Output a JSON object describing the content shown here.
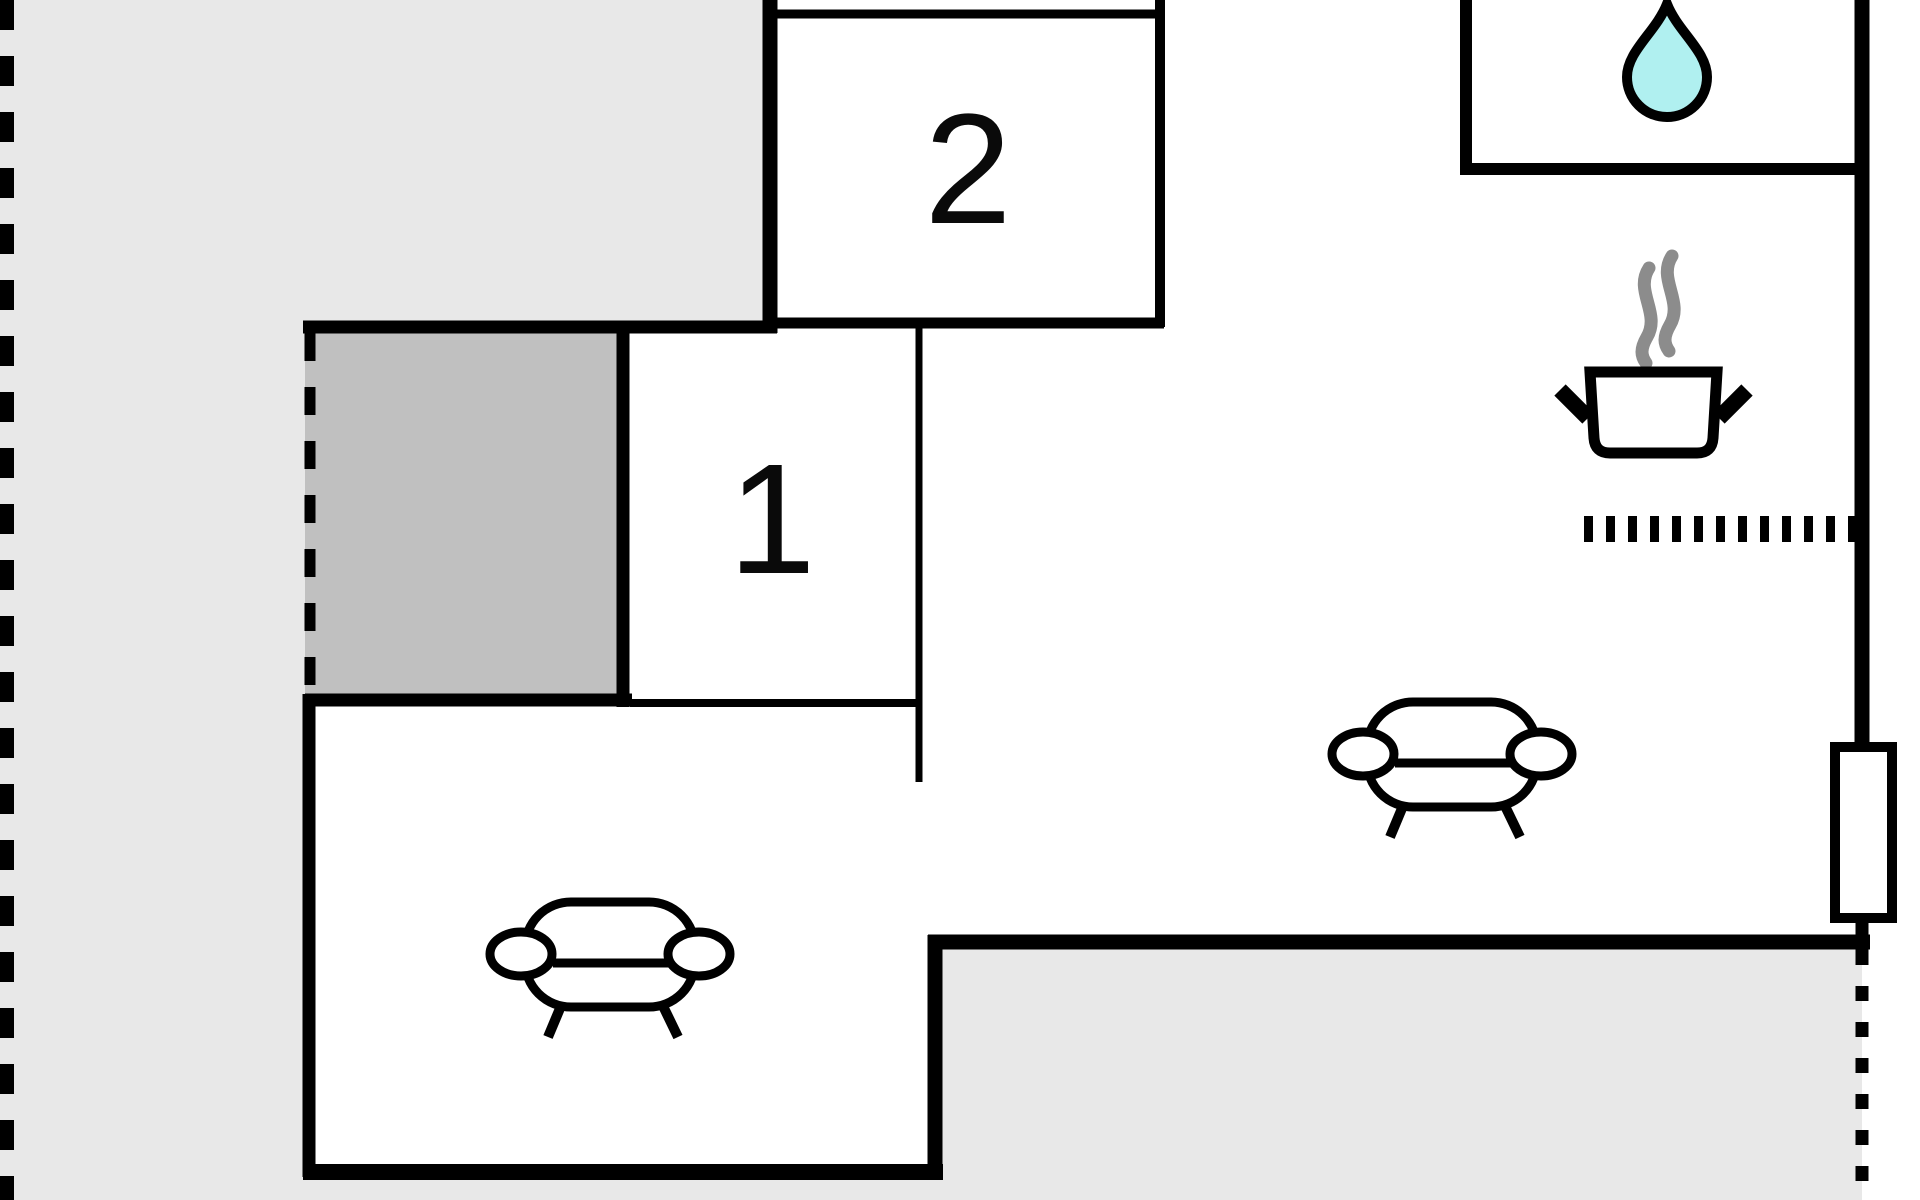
{
  "document": {
    "title": "Holiday home floor plan",
    "type": "floor-plan"
  },
  "rooms": {
    "room1": {
      "label": "1",
      "kind": "bedroom"
    },
    "room2": {
      "label": "2",
      "kind": "bedroom"
    },
    "bathroom": {
      "icon": "water-drop"
    },
    "kitchen": {
      "icons": [
        "steam",
        "cooking-pot",
        "stove-dotted-line"
      ]
    },
    "living_room": {
      "icon": "sofa"
    },
    "lounge_bottom_left": {
      "icon": "sofa"
    }
  },
  "features": {
    "window_right_wall": "window",
    "left_boundary": "dashed-property-line",
    "patio_left_boundary": "dashed-opening",
    "right_lower_boundary": "dashed-opening"
  },
  "colors": {
    "background": "#ffffff",
    "outdoor_light_gray": "#e8e8e8",
    "patio_dark_gray": "#c0c0c0",
    "wall_black": "#000000",
    "water_cyan": "#b0f0f0",
    "steam_gray": "#8c8c8c"
  }
}
